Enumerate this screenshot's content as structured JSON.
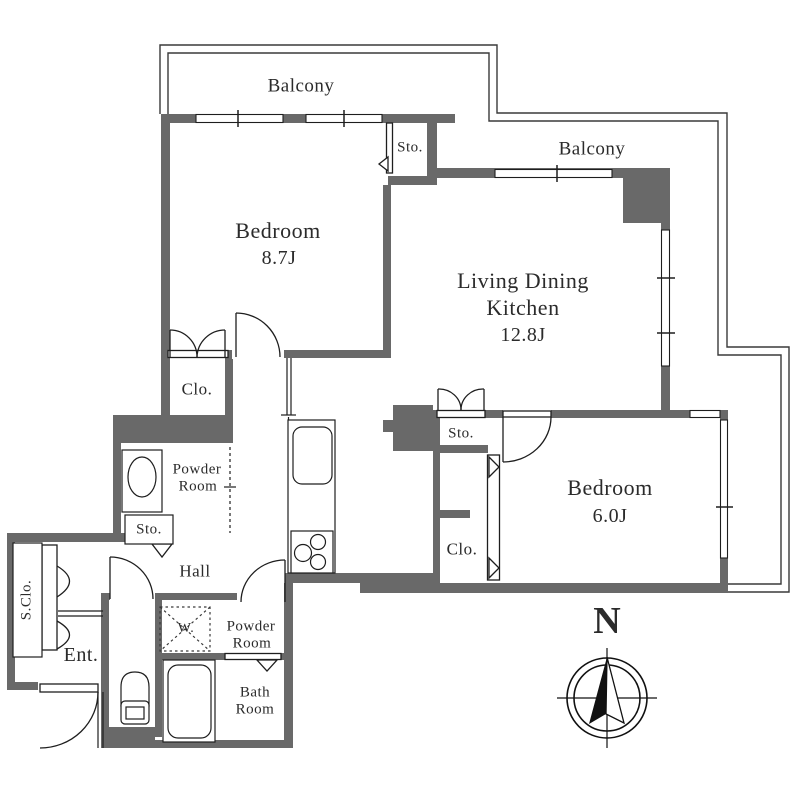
{
  "title": "2LDK apartment floor plan",
  "colors": {
    "wall": "#696969",
    "line": "#1e1e1e",
    "text": "#2b2b2b",
    "bg": "#ffffff"
  },
  "compass": {
    "label": "N"
  },
  "rooms": {
    "balcony_top": {
      "label": "Balcony"
    },
    "balcony_right": {
      "label": "Balcony"
    },
    "bedroom1": {
      "label": "Bedroom",
      "size": "8.7J"
    },
    "ldk": {
      "line1": "Living Dining",
      "line2": "Kitchen",
      "size": "12.8J"
    },
    "bedroom2": {
      "label": "Bedroom",
      "size": "6.0J"
    },
    "storage_top": {
      "label": "Sto."
    },
    "storage_mid": {
      "label": "Sto."
    },
    "storage_hall": {
      "label": "Sto."
    },
    "closet_upper": {
      "label": "Clo."
    },
    "closet_lower": {
      "label": "Clo."
    },
    "powder_room_upper": {
      "line1": "Powder",
      "line2": "Room"
    },
    "powder_room_lower": {
      "line1": "Powder",
      "line2": "Room"
    },
    "hall": {
      "label": "Hall"
    },
    "shoe_closet": {
      "label": "S.Clo."
    },
    "entrance": {
      "label": "Ent."
    },
    "washer": {
      "label": "W."
    },
    "bathroom": {
      "line1": "Bath",
      "line2": "Room"
    }
  }
}
